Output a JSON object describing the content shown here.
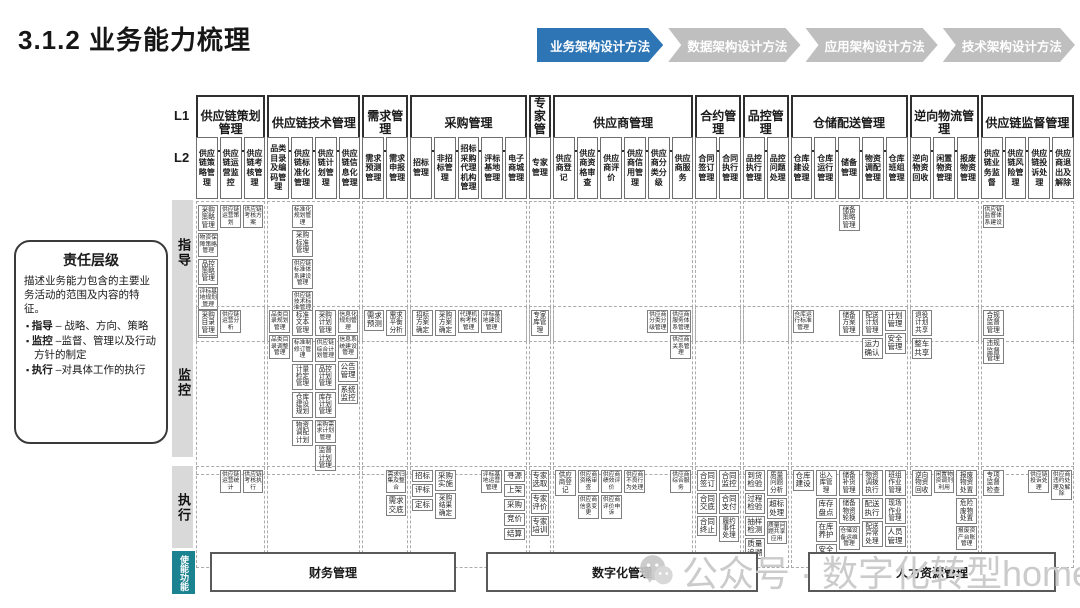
{
  "title": "3.1.2 业务能力梳理",
  "tabs": [
    {
      "label": "业务架构设计方法",
      "active": true
    },
    {
      "label": "数据架构设计方法",
      "active": false
    },
    {
      "label": "应用架构设计方法",
      "active": false
    },
    {
      "label": "技术架构设计方法",
      "active": false
    }
  ],
  "legend": {
    "title": "责任层级",
    "desc": "描述业务能力包含的主要业务活动的范围及内容的特征。",
    "bullets": [
      {
        "term": "指导",
        "text": " – 战略、方向、策略"
      },
      {
        "term": "监控",
        "text": " –监督、管理以及行动方针的制定"
      },
      {
        "term": "执行",
        "text": " –对具体工作的执行"
      }
    ]
  },
  "levels": {
    "l1": "L1",
    "l2": "L2"
  },
  "bands": [
    {
      "id": "guide",
      "label": "指导"
    },
    {
      "id": "monitor",
      "label": "监控"
    },
    {
      "id": "execute",
      "label": "执行"
    }
  ],
  "groups": [
    {
      "name": "供应链策划管理",
      "children": [
        "供应链策略管理",
        "供应链运营监控",
        "供应链考核管理"
      ]
    },
    {
      "name": "供应链技术管理",
      "children": [
        "品类目录及编码管理",
        "供应链标准化管理",
        "供应链计划管理",
        "供应链信息化管理"
      ]
    },
    {
      "name": "需求管理",
      "children": [
        "需求预测管理",
        "需求申报管理"
      ]
    },
    {
      "name": "采购管理",
      "children": [
        "招标管理",
        "非招标管理",
        "招标采购代理机构管理",
        "评标基地管理",
        "电子商城管理"
      ]
    },
    {
      "name": "专家管理",
      "children": [
        "专家管理"
      ]
    },
    {
      "name": "供应商管理",
      "children": [
        "供应商登记",
        "供应商资格审查",
        "供应商评价",
        "供应商信用管理",
        "供应商分类分级",
        "供应商服务"
      ]
    },
    {
      "name": "合约管理",
      "children": [
        "合同签订管理",
        "合同执行管理"
      ]
    },
    {
      "name": "品控管理",
      "children": [
        "品控执行管理",
        "品控问题处理"
      ]
    },
    {
      "name": "仓储配送管理",
      "children": [
        "仓库建设管理",
        "仓库运行管理",
        "储备管理",
        "物资调配管理",
        "仓库班组管理"
      ]
    },
    {
      "name": "逆向物流管理",
      "children": [
        "逆向物资回收",
        "闲置物资管理",
        "报废物资管理"
      ]
    },
    {
      "name": "供应链监督管理",
      "children": [
        "供应链业务监督",
        "供应链风险管理",
        "供应链投诉处理",
        "供应商退出及解除"
      ]
    }
  ],
  "cells": {
    "guide": [
      {
        "g": 0,
        "c": 0,
        "items": [
          "采购策略管理",
          "物资保障策略管理",
          "品控策略管理",
          "评标基地规划管理",
          "仓库规划管理"
        ]
      },
      {
        "g": 0,
        "c": 1,
        "items": [
          "供应链运营策划"
        ]
      },
      {
        "g": 0,
        "c": 2,
        "items": [
          "供应链考核方案"
        ]
      },
      {
        "g": 1,
        "c": 1,
        "items": [
          "标准化规划管理",
          "采购标准管理",
          "供应链标准体系建设管理",
          "供应链技术标准管理"
        ]
      },
      {
        "g": 8,
        "c": 2,
        "items": [
          "储备策略管理"
        ]
      },
      {
        "g": 10,
        "c": 0,
        "items": [
          "供应链监督体系建设"
        ]
      }
    ],
    "monitor": [
      {
        "g": 0,
        "c": 0,
        "items": [
          "采购目录管理"
        ]
      },
      {
        "g": 0,
        "c": 1,
        "items": [
          "供应链运营分析"
        ]
      },
      {
        "g": 1,
        "c": 0,
        "items": [
          "品类目录规划管理",
          "品类目录调整管理"
        ]
      },
      {
        "g": 1,
        "c": 1,
        "items": [
          "标准文本管理",
          "标准制修订管理",
          "计量检定管理",
          "仓库建设规划",
          "物资调配计划"
        ]
      },
      {
        "g": 1,
        "c": 2,
        "items": [
          "采购计划管理",
          "供应链综合计划管理",
          "品控计划管理",
          "库存计划管理",
          "采购需求计划管理",
          "监督计划管理"
        ]
      },
      {
        "g": 1,
        "c": 3,
        "items": [
          "信息化规划管理",
          "信息系统建设管理",
          "公告管理",
          "系统监控"
        ]
      },
      {
        "g": 2,
        "c": 0,
        "items": [
          "需求预测"
        ]
      },
      {
        "g": 2,
        "c": 1,
        "items": [
          "需求平衡分析"
        ]
      },
      {
        "g": 3,
        "c": 0,
        "items": [
          "招标方案确定"
        ]
      },
      {
        "g": 3,
        "c": 1,
        "items": [
          "采购方案确定"
        ]
      },
      {
        "g": 3,
        "c": 2,
        "items": [
          "代理机构考核管理"
        ]
      },
      {
        "g": 3,
        "c": 3,
        "items": [
          "评标基地建设管理"
        ]
      },
      {
        "g": 4,
        "c": 0,
        "items": [
          "专家库管理"
        ]
      },
      {
        "g": 5,
        "c": 4,
        "items": [
          "供应商分类分级管理"
        ]
      },
      {
        "g": 5,
        "c": 5,
        "items": [
          "供应商服务体系管理",
          "供应商关系管理"
        ]
      },
      {
        "g": 8,
        "c": 0,
        "items": [
          "仓库运行标准管理"
        ]
      },
      {
        "g": 8,
        "c": 2,
        "items": [
          "储备方案管理"
        ]
      },
      {
        "g": 8,
        "c": 3,
        "items": [
          "配送计划管理",
          "运力确认"
        ]
      },
      {
        "g": 8,
        "c": 4,
        "items": [
          "计划管理",
          "安全管理"
        ]
      },
      {
        "g": 9,
        "c": 0,
        "items": [
          "退役计划共享",
          "整车共享"
        ]
      },
      {
        "g": 10,
        "c": 0,
        "items": [
          "合规监督管理",
          "违规监督管理"
        ]
      }
    ],
    "execute": [
      {
        "g": 0,
        "c": 1,
        "items": [
          "供应链运营统计"
        ]
      },
      {
        "g": 0,
        "c": 2,
        "items": [
          "供应链考核执行"
        ]
      },
      {
        "g": 2,
        "c": 1,
        "items": [
          "需求归集及整合",
          "需求交底"
        ]
      },
      {
        "g": 3,
        "c": 0,
        "items": [
          "招标",
          "评标",
          "定标"
        ]
      },
      {
        "g": 3,
        "c": 1,
        "items": [
          "采购实施",
          "采购结果确定"
        ]
      },
      {
        "g": 3,
        "c": 3,
        "items": [
          "评标基地运营管理"
        ]
      },
      {
        "g": 3,
        "c": 4,
        "items": [
          "寻源",
          "上架",
          "采购",
          "竞价",
          "结算"
        ]
      },
      {
        "g": 4,
        "c": 0,
        "items": [
          "专家选取",
          "专家评价",
          "专家培训"
        ]
      },
      {
        "g": 5,
        "c": 0,
        "items": [
          "供应商登记"
        ]
      },
      {
        "g": 5,
        "c": 1,
        "items": [
          "供应商资格审查",
          "供应商信息变更"
        ]
      },
      {
        "g": 5,
        "c": 2,
        "items": [
          "供应商绩效评价",
          "供应商评价申诉"
        ]
      },
      {
        "g": 5,
        "c": 3,
        "items": [
          "供应商不良行为处理"
        ]
      },
      {
        "g": 5,
        "c": 5,
        "items": [
          "供应商综合服务"
        ]
      },
      {
        "g": 6,
        "c": 0,
        "items": [
          "合同签订",
          "合同交底",
          "合同终止"
        ]
      },
      {
        "g": 6,
        "c": 1,
        "items": [
          "合同监控",
          "合同支付",
          "履约事件处理"
        ]
      },
      {
        "g": 7,
        "c": 0,
        "items": [
          "到货检验",
          "过程检验",
          "抽样检测",
          "质量追溯"
        ]
      },
      {
        "g": 7,
        "c": 1,
        "items": [
          "质量问题分析",
          "超标处理",
          "质量问题共享应用"
        ]
      },
      {
        "g": 8,
        "c": 0,
        "items": [
          "仓库建设"
        ]
      },
      {
        "g": 8,
        "c": 1,
        "items": [
          "出入库管理",
          "库存盘点",
          "在库养护",
          "安全巡检"
        ]
      },
      {
        "g": 8,
        "c": 2,
        "items": [
          "储备补货管理",
          "储备物资轮换",
          "仓储设备运维管理"
        ]
      },
      {
        "g": 8,
        "c": 3,
        "items": [
          "物资调拨执行",
          "配送执行",
          "配送异常处理"
        ]
      },
      {
        "g": 8,
        "c": 4,
        "items": [
          "班组作业管理",
          "现场作业管理",
          "人员管理"
        ]
      },
      {
        "g": 9,
        "c": 0,
        "items": [
          "逆向物资回收"
        ]
      },
      {
        "g": 9,
        "c": 1,
        "items": [
          "闲置物资调剂利用"
        ]
      },
      {
        "g": 9,
        "c": 2,
        "items": [
          "报废物资处置",
          "危险废物处置",
          "报废资产台账管理"
        ]
      },
      {
        "g": 10,
        "c": 0,
        "items": [
          "专项监督检查"
        ]
      },
      {
        "g": 10,
        "c": 2,
        "items": [
          "供应链投诉处理"
        ]
      },
      {
        "g": 10,
        "c": 3,
        "items": [
          "供应商违约处理及解除"
        ]
      }
    ]
  },
  "enable": {
    "label": "使能功能",
    "boxes": [
      "财务管理",
      "数字化管理",
      "人力资源管理"
    ]
  },
  "watermark": {
    "icon": "wechat-icon",
    "text": "公众号 · 数字化转型home"
  },
  "colors": {
    "tab_active": "#2E75B6",
    "tab_inactive": "#BFBFBF",
    "enable_teal": "#1B8290",
    "strip_gray": "#D9D9D9",
    "watermark_gray": "#CBCBCB"
  }
}
